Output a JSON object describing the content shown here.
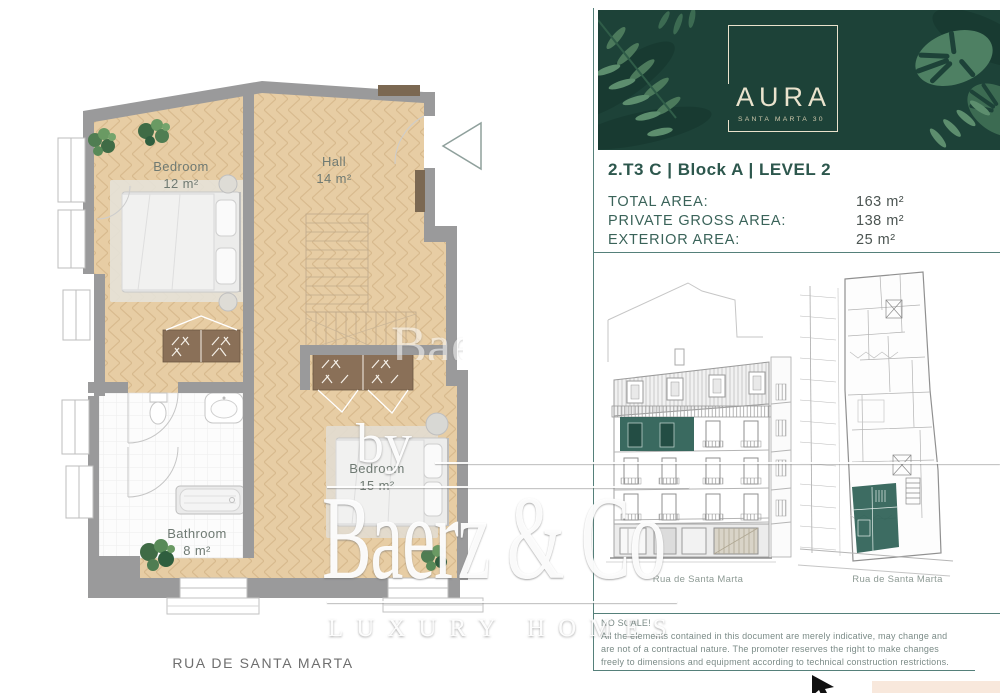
{
  "floor_plan": {
    "rooms": [
      {
        "name": "Bedroom",
        "area": "12 m²"
      },
      {
        "name": "Hall",
        "area": "14 m²"
      },
      {
        "name": "Bathroom",
        "area": "8 m²"
      },
      {
        "name": "Bedroom",
        "area": "15 m²"
      }
    ],
    "street_label": "RUA DE SANTA MARTA"
  },
  "panel": {
    "logo": {
      "name": "AURA",
      "subtitle": "SANTA MARTA 30"
    },
    "unit_title": "2.T3 C | Block A | LEVEL 2",
    "areas": [
      {
        "label": "TOTAL AREA:",
        "value": "163 m²"
      },
      {
        "label": "PRIVATE GROSS AREA:",
        "value": "138 m²"
      },
      {
        "label": "EXTERIOR AREA:",
        "value": "25 m²"
      }
    ],
    "elevation_caption": "Rua de Santa Marta",
    "siteplan_caption": "Rua de Santa Marta",
    "disclaimer_lines": [
      "NO SCALE!",
      "All the elements contained in this document are merely indicative, may change and",
      "are not of a contractual nature. The promoter reserves the right to make changes",
      "freely to dimensions and equipment according to technical construction restrictions."
    ]
  },
  "watermark": {
    "by": "by",
    "name": "Baerz & Co",
    "tagline": "LUXURY HOMES",
    "fragment": "Bae"
  },
  "colors": {
    "brand_green": "#1d4238",
    "accent_teal": "#2e6156",
    "panel_line": "#55807a",
    "floor_tan": "#e7cda4",
    "wall_gray": "#9a9a9b"
  }
}
